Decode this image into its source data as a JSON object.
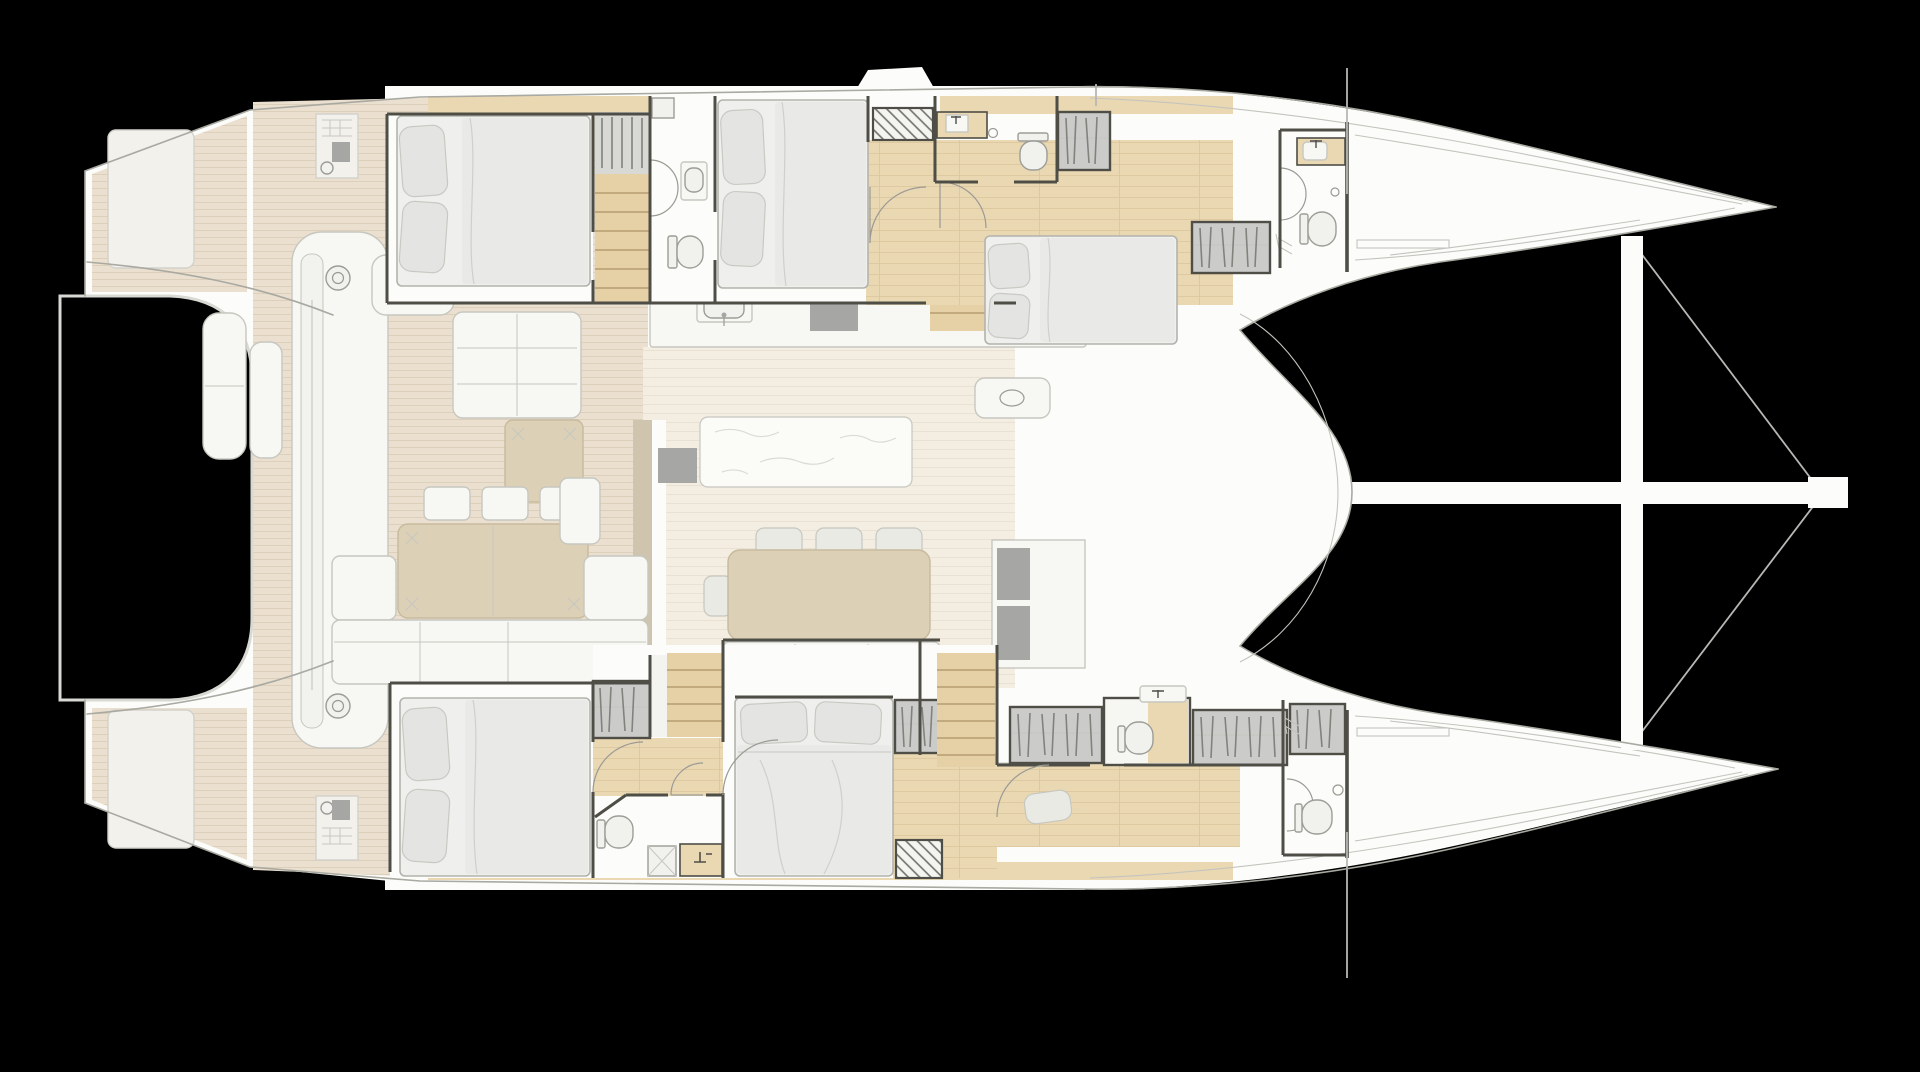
{
  "vessel": {
    "type": "sailing-catamaran",
    "view": "overhead-deck-and-accommodation-plan",
    "orientation": "bow-right",
    "hull_count": 2
  },
  "palette": {
    "background": "#000000",
    "hull": "#fcfcfa",
    "hull_outline": "#a9a9a2",
    "thin_line": "#c4c4be",
    "wall": "#4e4e47",
    "deck_base": "#ebe0cf",
    "deck_stripe": "#ddd0bb",
    "saloon_base": "#f3ede2",
    "saloon_stripe": "#e9e1d3",
    "wood": "#ead8b3",
    "wood_grain": "#dcc59a",
    "step_base": "#e6d0a6",
    "tread": "#b79d70",
    "furniture_white": "#f7f7f4",
    "furniture_border": "#c7c7c0",
    "furniture_tan": "#dcd0b6",
    "furniture_tan_border": "#c8ba9d",
    "mattress": "#efefed",
    "bed_border": "#b3b3ad",
    "pillow": "#e4e4e2",
    "pillow_border": "#c9c9c4",
    "duvet": "#e9e9e7",
    "fold": "#cfcfcb",
    "wardrobe": "#cbcbca",
    "hanger": "#82827d",
    "appliance": "#a6a6a4",
    "marble": "#fbfbf8",
    "marble_vein": "#dbdbd5",
    "fixture": "#f1f1ee",
    "fixture_border": "#9d9d97",
    "door_arc": "#9a9a94",
    "rigging": "#b7b7b3",
    "hatch_line": "#71716b",
    "rim": "#d9d9d4",
    "landing": "#f3f3f0",
    "panel": "#f3f1ec",
    "panel_border": "#d2d1cb",
    "chair": "#e9eae4",
    "wall_tan": "#cfc4ae"
  },
  "areas": [
    {
      "name": "aft-deck-cockpit",
      "features": [
        "transom-platforms",
        "tender-recess",
        "cockpit-sofa",
        "cockpit-ottoman-table",
        "sun-pads",
        "chaise-lounge",
        "traveler-bench-with-winches",
        "deck-consoles"
      ]
    },
    {
      "name": "saloon",
      "features": [
        "galley-counter",
        "galley-sink",
        "cooktop",
        "kitchen-island",
        "dining-table",
        "dining-chairs",
        "saloon-sofa",
        "tv-cabinet",
        "chart-module"
      ]
    },
    {
      "name": "port-hull",
      "features": [
        "aft-guest-cabin-double-bed",
        "staircase",
        "bathroom-shower-toilet-sink",
        "mid-guest-cabin-double-bed",
        "technical-space",
        "vip-cabin-double-bed",
        "wardrobes",
        "forward-head",
        "forepeak-locker"
      ]
    },
    {
      "name": "starboard-hull",
      "features": [
        "aft-guest-cabin-double-bed",
        "staircase",
        "master-cabin-double-bed",
        "master-bathroom-shower-toilet-sink",
        "wardrobes",
        "vanity-desk-with-chair",
        "toilet-alcove",
        "forward-head",
        "forepeak-locker"
      ]
    },
    {
      "name": "foredeck",
      "features": [
        "forward-crossbeam",
        "bowsprit",
        "bridle-rigging-wires",
        "bow-tips"
      ]
    }
  ],
  "icons": [
    "double-bed-icon",
    "pillow-icon",
    "wardrobe-hangers-icon",
    "toilet-icon",
    "sink-icon",
    "shower-door-arc-icon",
    "shower-tray-icon",
    "staircase-icon",
    "winch-icon",
    "dining-table-icon",
    "chair-icon",
    "sofa-icon",
    "sun-pad-icon",
    "cooktop-icon",
    "kitchen-island-icon",
    "tv-cabinet-icon",
    "technical-hatch-icon",
    "door-swing-arc-icon",
    "bowsprit-icon",
    "rigging-wire-icon"
  ]
}
